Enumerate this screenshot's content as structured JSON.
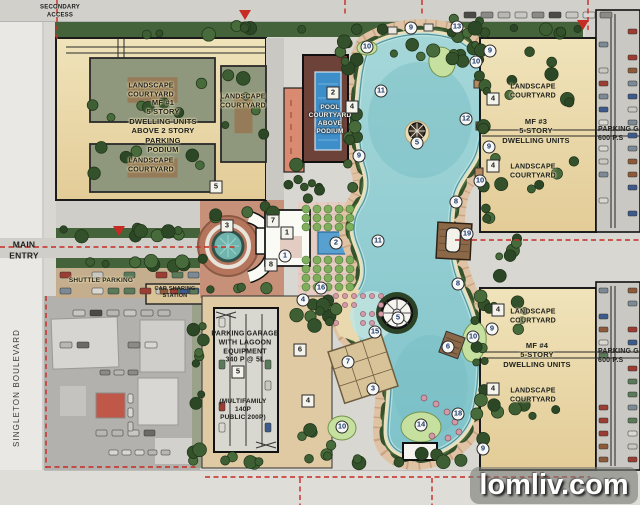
{
  "title": "Lagoon community master site plan",
  "streets": {
    "singleton_boulevard": "SINGLETON BOULEVARD"
  },
  "labels": {
    "secondary_access": "SECONDARY\nACCESS",
    "main_entry": "MAIN\nENTRY",
    "shuttle_parking": "SHUTTLE PARKING",
    "car_sharing_station": "CAR SHARING\nSTATION",
    "landscape_courtyard": "LANDSCAPE\nCOURTYARD",
    "mf1": "MF #1\n5 STORY\nDWELLING UNITS\nABOVE 2 STORY\nPARKING\nPODIUM",
    "pool_courtyard": "POOL\nCOURTYARD\nABOVE\nPODIUM",
    "mf3": "MF #3\n5-STORY\nDWELLING UNITS",
    "mf4": "MF #4\n5-STORY\nDWELLING UNITS",
    "parking_garage_lagoon": "PARKING GARAGE\nWITH LAGOON\nEQUIPMENT\n340 P @ 5L",
    "parking_garage_lagoon_capacity": "(MULTIFAMILY\n140P\nPUBLIC   200P)",
    "parking_garage_east": "PARKING GA\n600 P.S"
  },
  "watermark": {
    "text": "lomliv.com"
  },
  "colors": {
    "water": "#8fc9cf",
    "sand": "#ecdfb9",
    "building_tan": "#ead7a6",
    "tree_green": "#3c5a33",
    "axis_red": "#c62b24",
    "pool_blue": "#3e8ec9",
    "watermark_bg": "rgba(124,124,119,0.62)"
  },
  "badges": [
    {
      "shape": "square",
      "n": "2",
      "x": 333,
      "y": 93
    },
    {
      "shape": "square",
      "n": "5",
      "x": 216,
      "y": 187
    },
    {
      "shape": "square",
      "n": "3",
      "x": 227,
      "y": 226
    },
    {
      "shape": "square",
      "n": "7",
      "x": 273,
      "y": 221
    },
    {
      "shape": "square",
      "n": "1",
      "x": 287,
      "y": 233
    },
    {
      "shape": "square",
      "n": "8",
      "x": 271,
      "y": 265
    },
    {
      "shape": "circle",
      "n": "1",
      "x": 285,
      "y": 256
    },
    {
      "shape": "circle",
      "n": "2",
      "x": 336,
      "y": 243
    },
    {
      "shape": "circle",
      "n": "16",
      "x": 321,
      "y": 288
    },
    {
      "shape": "circle",
      "n": "4",
      "x": 303,
      "y": 300
    },
    {
      "shape": "square",
      "n": "5",
      "x": 238,
      "y": 372
    },
    {
      "shape": "square",
      "n": "6",
      "x": 300,
      "y": 350
    },
    {
      "shape": "square",
      "n": "4",
      "x": 308,
      "y": 401
    },
    {
      "shape": "circle",
      "n": "9",
      "x": 411,
      "y": 28
    },
    {
      "shape": "circle",
      "n": "13",
      "x": 457,
      "y": 27
    },
    {
      "shape": "circle",
      "n": "10",
      "x": 367,
      "y": 47
    },
    {
      "shape": "circle",
      "n": "9",
      "x": 490,
      "y": 51
    },
    {
      "shape": "circle",
      "n": "10",
      "x": 476,
      "y": 62
    },
    {
      "shape": "circle",
      "n": "11",
      "x": 381,
      "y": 91
    },
    {
      "shape": "square",
      "n": "4",
      "x": 352,
      "y": 107
    },
    {
      "shape": "square",
      "n": "4",
      "x": 493,
      "y": 99
    },
    {
      "shape": "circle",
      "n": "12",
      "x": 466,
      "y": 119
    },
    {
      "shape": "circle",
      "n": "5",
      "x": 417,
      "y": 143
    },
    {
      "shape": "circle",
      "n": "9",
      "x": 489,
      "y": 147
    },
    {
      "shape": "circle",
      "n": "9",
      "x": 359,
      "y": 156
    },
    {
      "shape": "square",
      "n": "4",
      "x": 493,
      "y": 166
    },
    {
      "shape": "circle",
      "n": "10",
      "x": 480,
      "y": 181
    },
    {
      "shape": "circle",
      "n": "8",
      "x": 456,
      "y": 202
    },
    {
      "shape": "circle",
      "n": "19",
      "x": 467,
      "y": 234
    },
    {
      "shape": "circle",
      "n": "11",
      "x": 378,
      "y": 241
    },
    {
      "shape": "circle",
      "n": "8",
      "x": 458,
      "y": 284
    },
    {
      "shape": "square",
      "n": "4",
      "x": 498,
      "y": 310
    },
    {
      "shape": "circle",
      "n": "5",
      "x": 398,
      "y": 318
    },
    {
      "shape": "circle",
      "n": "9",
      "x": 492,
      "y": 329
    },
    {
      "shape": "circle",
      "n": "15",
      "x": 375,
      "y": 332
    },
    {
      "shape": "circle",
      "n": "10",
      "x": 473,
      "y": 337
    },
    {
      "shape": "circle",
      "n": "6",
      "x": 448,
      "y": 347
    },
    {
      "shape": "circle",
      "n": "7",
      "x": 348,
      "y": 362
    },
    {
      "shape": "circle",
      "n": "3",
      "x": 373,
      "y": 389
    },
    {
      "shape": "square",
      "n": "4",
      "x": 493,
      "y": 389
    },
    {
      "shape": "circle",
      "n": "18",
      "x": 458,
      "y": 414
    },
    {
      "shape": "circle",
      "n": "14",
      "x": 421,
      "y": 425
    },
    {
      "shape": "circle",
      "n": "10",
      "x": 342,
      "y": 427
    },
    {
      "shape": "circle",
      "n": "9",
      "x": 483,
      "y": 449
    }
  ]
}
